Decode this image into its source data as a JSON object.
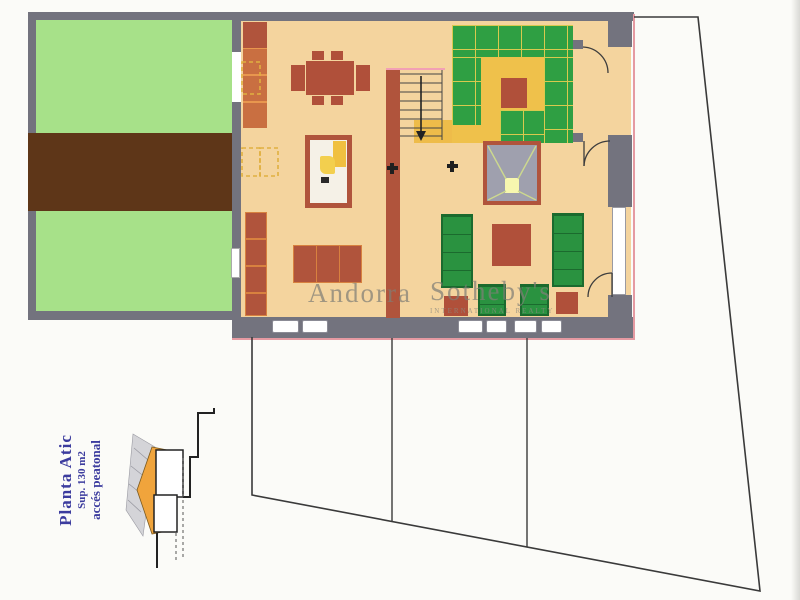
{
  "watermark": {
    "left": "Andorra",
    "right": "Sotheby's",
    "subtitle": "INTERNATIONAL REALTY"
  },
  "plan_label": {
    "title": "Planta Atic",
    "area": "Sup. 130 m2",
    "access": "accés peatonal"
  },
  "palette": {
    "floor_tan": "#f4d49e",
    "wall_gray": "#73737e",
    "garden_green": "#a7e189",
    "earth_brown": "#5e3618",
    "furniture_red": "#b0503a",
    "kitchen_tile_green": "#2f9f43",
    "kitchen_floor_yellow": "#efc14b",
    "landing_orange": "#eebc4a",
    "section_roof_orange": "#f0a43c",
    "sofa_green": "#2a9240",
    "label_blue": "#3c3c9e",
    "boundary_line": "#3a3a3a",
    "plan_outline_pink": "#e59aa2",
    "skylight_gray": "#9fa0ae"
  }
}
